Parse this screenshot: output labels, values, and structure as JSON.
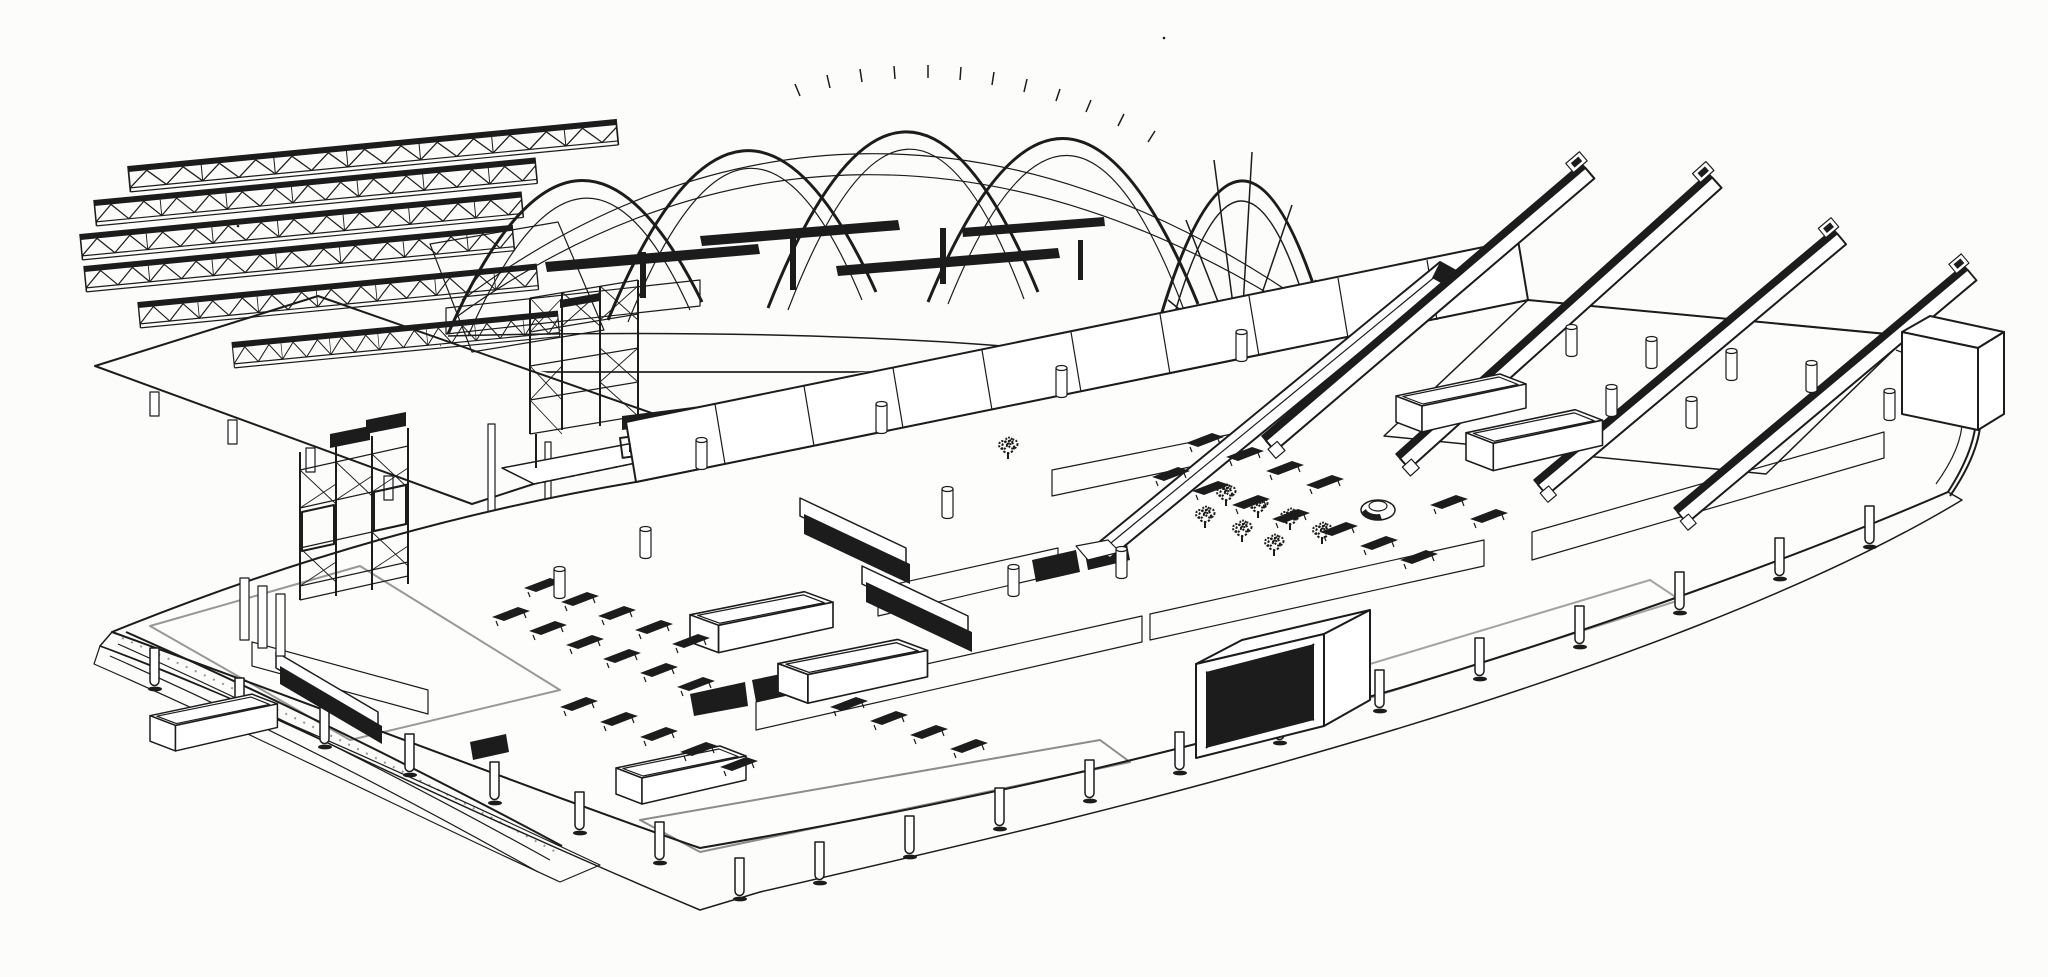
{
  "figure": {
    "type": "axonometric-line-drawing",
    "alt": "Exploded axonometric ink drawing of a railway terminal: above, a glazed vaulted trainshed roof with parallel lattice trusses, a gridded canopy deck and a support gantry; below, a long curved concourse floor plate with back wall panels, banks of escalators, an inclined travelator, stair wells, a black cross-braced skylight box, a lattice lift tower, rows of benches, planting, a circular kiosk, slatted balustrades, curved platform tracks and cylindrical columns under the slab.",
    "medium": "black ink line work on white paper",
    "colors": {
      "ink": "#1c1c1c",
      "paper": "#fcfcfb"
    },
    "components": {
      "roof": [
        "lattice-roof-trusses",
        "gridded-canopy-deck",
        "support-gantry",
        "arched-trainshed-vault",
        "gable-end-arch",
        "eaves-gutter-walkway"
      ],
      "concourse": [
        "curved-floor-plate",
        "back-wall-panels",
        "bank-of-four-escalators",
        "inclined-travelator",
        "concourse-escalators",
        "stair-wells",
        "skylight-cross-box",
        "lattice-lift-tower",
        "seating-benches",
        "planting",
        "circular-kiosk",
        "balustrade-fences",
        "underfloor-columns",
        "curved-platform-tracks",
        "mezzanine-deck"
      ]
    }
  }
}
